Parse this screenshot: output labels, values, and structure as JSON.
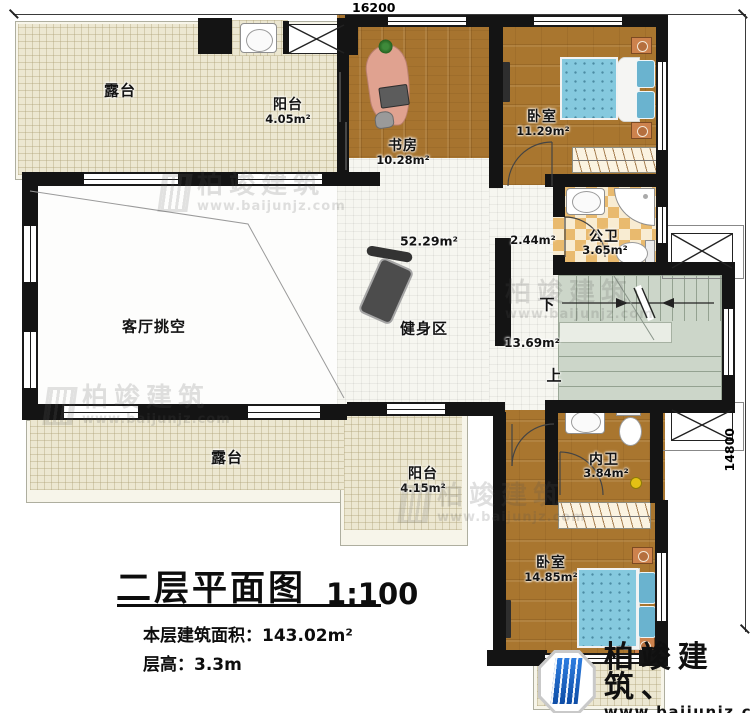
{
  "dimensions": {
    "top": "16200",
    "right": "14800"
  },
  "rooms": {
    "terrace_top": {
      "label": "露台"
    },
    "balcony_top": {
      "label": "阳台",
      "area": "4.05m²"
    },
    "study": {
      "label": "书房",
      "area": "10.28m²"
    },
    "bedroom_top": {
      "label": "卧室",
      "area": "11.29m²"
    },
    "hall_upper": {
      "area": "2.44m²"
    },
    "public_bath": {
      "label": "公卫",
      "area": "3.65m²"
    },
    "gym": {
      "label": "健身区",
      "area": "52.29m²"
    },
    "living_void": {
      "label": "客厅挑空"
    },
    "stair_hall": {
      "area": "13.69m²",
      "down": "下",
      "up": "上"
    },
    "terrace_bottom": {
      "label": "露台"
    },
    "balcony_bottom": {
      "label": "阳台",
      "area": "4.15m²"
    },
    "ensuite_bath": {
      "label": "内卫",
      "area": "3.84m²"
    },
    "bedroom_bottom": {
      "label": "卧室",
      "area": "14.85m²"
    },
    "terrace_corner": {
      "label": "露台"
    }
  },
  "title_block": {
    "title": "二层平面图",
    "scale": "1:100",
    "area_label": "本层建筑面积：",
    "area_value": "143.02m²",
    "floor_height_label": "层高：",
    "floor_height_value": "3.3m"
  },
  "branding": {
    "name": "柏竣建筑",
    "mark": "、",
    "website": "www.baijunjz.com"
  },
  "watermark": {
    "name": "柏竣建筑",
    "website": "www.baijunjz.com"
  },
  "colors": {
    "wall": "#141414",
    "wood": "#a9762f",
    "terrace": "#ece7d1",
    "tile": "#f6f6f0",
    "bath_checker": "#e9ba6e",
    "stairs": "#ccd6c9",
    "bed": "#85c9de",
    "logo_blue": "#1a63c4"
  }
}
